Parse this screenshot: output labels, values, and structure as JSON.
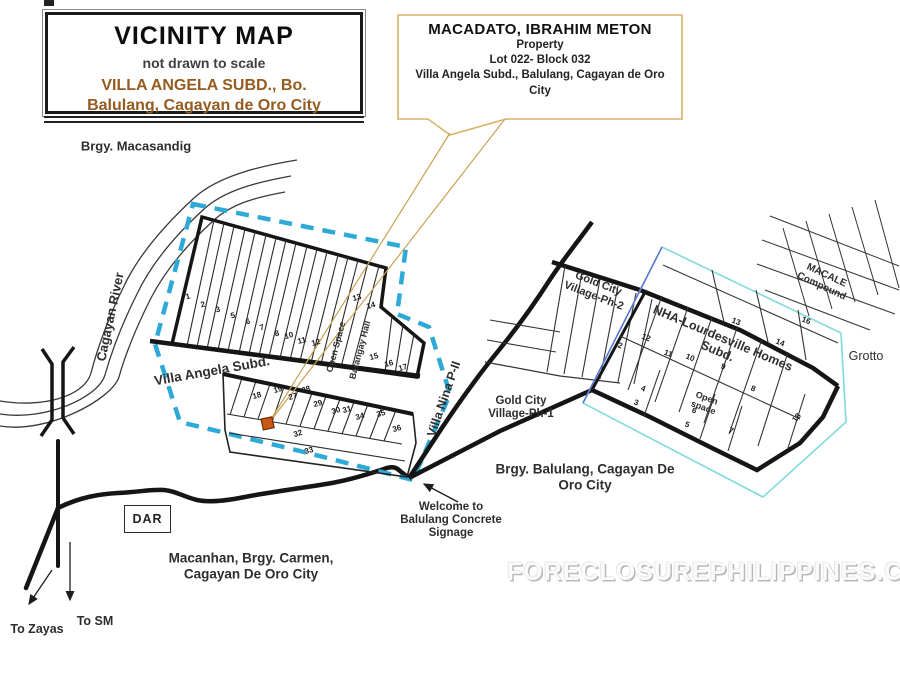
{
  "title_box": {
    "title": "VICINITY MAP",
    "subtitle": "not drawn to scale",
    "location": "VILLA ANGELA SUBD., Bo.\nBalulang, Cagayan de Oro City"
  },
  "callout": {
    "owner": "MACADATO, IBRAHIM METON",
    "line1": "Property",
    "line2": "Lot 022- Block 032",
    "line3": "Villa Angela  Subd.,  Balulang, Cagayan de Oro\nCity"
  },
  "watermark": "FORECLOSUREPHILIPPINES.COM",
  "colors": {
    "dashed_border": "#2FA9D6",
    "cyan_outline": "#86DCDC",
    "blue_line": "#5A6FD0",
    "callout_border": "#D8B268",
    "callout_pointer_line": "#C9A154",
    "marker_fill": "#C85A17",
    "road_black": "#151515",
    "brown_text": "#955B20"
  },
  "map": {
    "dar_label": "DAR",
    "labels": [
      {
        "name": "label-brgy-macasandig",
        "text": "Brgy. Macasandig",
        "x": 136,
        "y": 147,
        "size": 13,
        "weight": 700
      },
      {
        "name": "label-cagayan-river",
        "text": "Cagayan River",
        "x": 111,
        "y": 317,
        "rot": -78,
        "size": 13,
        "weight": 700
      },
      {
        "name": "label-villa-angela-subd",
        "text": "Villa Angela Subd.",
        "x": 212,
        "y": 371,
        "rot": -10,
        "size": 13.5,
        "weight": 700
      },
      {
        "name": "label-open-space-villa-angela",
        "text": "Open Space",
        "x": 336,
        "y": 347,
        "rot": -75,
        "size": 9,
        "weight": 600
      },
      {
        "name": "label-barangay-hall",
        "text": "Barangay Hall",
        "x": 360,
        "y": 350,
        "rot": -75,
        "size": 9,
        "weight": 600
      },
      {
        "name": "label-villa-nina-road",
        "text": "Villa Nina P-II",
        "x": 444,
        "y": 399,
        "rot": -71,
        "size": 12.5,
        "weight": 700
      },
      {
        "name": "label-gold-city-ph2",
        "text": "Gold City\nVillage-Ph-2",
        "x": 596,
        "y": 290,
        "rot": 21,
        "size": 11,
        "weight": 700
      },
      {
        "name": "label-nha-lourdesville",
        "text": "NHA-Lourdesville Homes Subd.",
        "x": 720,
        "y": 345,
        "rot": 23,
        "size": 12.5,
        "weight": 700
      },
      {
        "name": "label-macale-compound",
        "text": "MACALE Compound",
        "x": 824,
        "y": 281,
        "rot": 25,
        "size": 10,
        "weight": 600
      },
      {
        "name": "label-grotto",
        "text": "Grotto",
        "x": 866,
        "y": 356,
        "size": 12.5,
        "weight": 500
      },
      {
        "name": "label-open-space-nha",
        "text": "Open\nspace",
        "x": 705,
        "y": 403,
        "rot": 20,
        "size": 9,
        "weight": 600
      },
      {
        "name": "label-gold-city-ph1",
        "text": "Gold City\nVillage-Ph-1",
        "x": 521,
        "y": 408,
        "size": 11.5,
        "weight": 700
      },
      {
        "name": "label-brgy-balulang",
        "text": "Brgy. Balulang, Cagayan De\nOro City",
        "x": 585,
        "y": 477,
        "size": 13.5,
        "weight": 700
      },
      {
        "name": "label-welcome-signage",
        "text": "Welcome to\nBalulang Concrete\nSignage",
        "x": 451,
        "y": 521,
        "size": 11.5,
        "weight": 700
      },
      {
        "name": "label-macanhan",
        "text": "Macanhan, Brgy. Carmen,\nCagayan De Oro City",
        "x": 251,
        "y": 566,
        "size": 13.5,
        "weight": 700
      },
      {
        "name": "label-to-zayas",
        "text": "To Zayas",
        "x": 37,
        "y": 629,
        "size": 12.5,
        "weight": 700
      },
      {
        "name": "label-to-sm",
        "text": "To SM",
        "x": 95,
        "y": 621,
        "size": 12.5,
        "weight": 700
      }
    ],
    "lot_groups": [
      {
        "name": "villa-angela",
        "rot": -15,
        "lots": [
          {
            "n": "1",
            "x": 188,
            "y": 297
          },
          {
            "n": "2",
            "x": 203,
            "y": 305
          },
          {
            "n": "3",
            "x": 218,
            "y": 310
          },
          {
            "n": "5",
            "x": 233,
            "y": 316
          },
          {
            "n": "6",
            "x": 248,
            "y": 322
          },
          {
            "n": "7",
            "x": 262,
            "y": 328
          },
          {
            "n": "8",
            "x": 277,
            "y": 334
          },
          {
            "n": "10",
            "x": 289,
            "y": 336
          },
          {
            "n": "11",
            "x": 302,
            "y": 341
          },
          {
            "n": "12",
            "x": 316,
            "y": 343
          },
          {
            "n": "13",
            "x": 357,
            "y": 298
          },
          {
            "n": "14",
            "x": 371,
            "y": 306
          },
          {
            "n": "15",
            "x": 374,
            "y": 357
          },
          {
            "n": "16",
            "x": 389,
            "y": 364
          },
          {
            "n": "17",
            "x": 403,
            "y": 368
          },
          {
            "n": "18",
            "x": 257,
            "y": 396
          },
          {
            "n": "19",
            "x": 278,
            "y": 390
          },
          {
            "n": "27",
            "x": 293,
            "y": 397
          },
          {
            "n": "28",
            "x": 306,
            "y": 390
          },
          {
            "n": "29",
            "x": 318,
            "y": 404
          },
          {
            "n": "30",
            "x": 336,
            "y": 411
          },
          {
            "n": "31",
            "x": 347,
            "y": 410
          },
          {
            "n": "34",
            "x": 360,
            "y": 417
          },
          {
            "n": "35",
            "x": 381,
            "y": 414
          },
          {
            "n": "36",
            "x": 397,
            "y": 429
          },
          {
            "n": "32",
            "x": 298,
            "y": 434
          },
          {
            "n": "33",
            "x": 309,
            "y": 451
          }
        ]
      },
      {
        "name": "nha",
        "rot": 21,
        "lots": [
          {
            "n": "2",
            "x": 620,
            "y": 346
          },
          {
            "n": "12",
            "x": 646,
            "y": 338
          },
          {
            "n": "11",
            "x": 668,
            "y": 354
          },
          {
            "n": "10",
            "x": 690,
            "y": 358
          },
          {
            "n": "9",
            "x": 723,
            "y": 367
          },
          {
            "n": "8",
            "x": 753,
            "y": 389
          },
          {
            "n": "13",
            "x": 736,
            "y": 322
          },
          {
            "n": "14",
            "x": 780,
            "y": 343
          },
          {
            "n": "16",
            "x": 806,
            "y": 321
          },
          {
            "n": "4",
            "x": 643,
            "y": 389
          },
          {
            "n": "3",
            "x": 636,
            "y": 403
          },
          {
            "n": "6",
            "x": 694,
            "y": 411
          },
          {
            "n": "5",
            "x": 687,
            "y": 425
          },
          {
            "n": "7",
            "x": 731,
            "y": 431
          },
          {
            "n": "18",
            "x": 797,
            "y": 418,
            "r": -50
          }
        ]
      }
    ]
  }
}
